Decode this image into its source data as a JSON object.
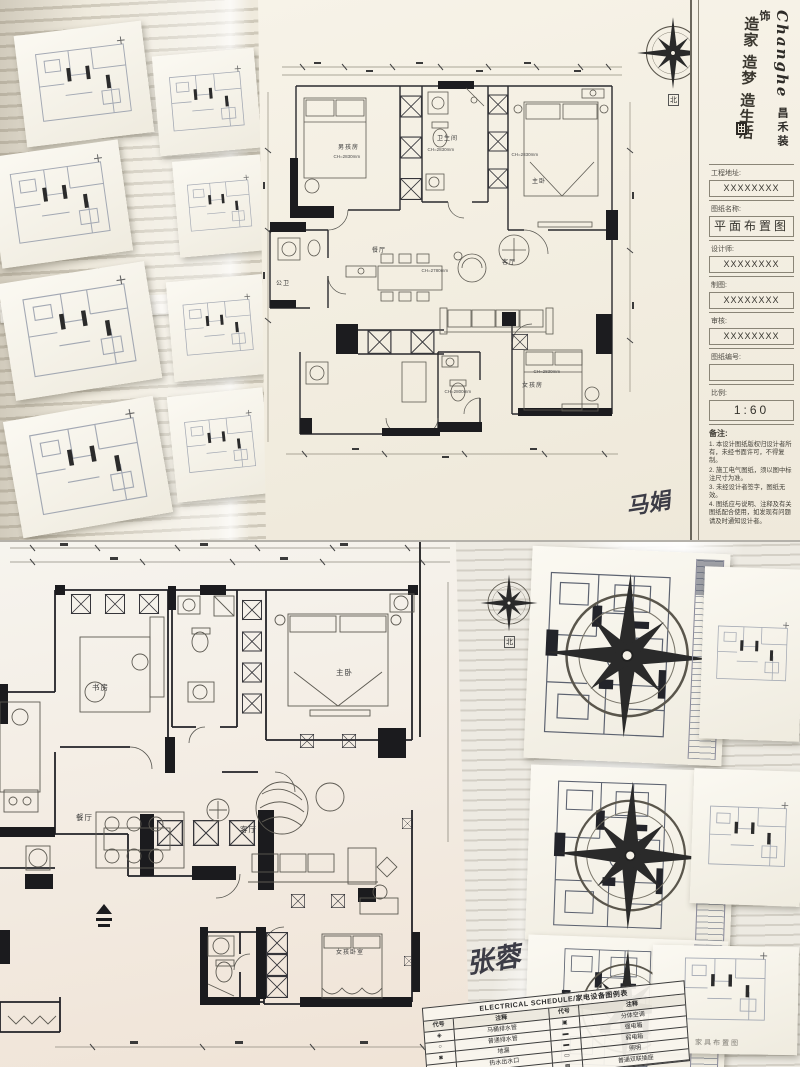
{
  "top": {
    "title_block": {
      "brand_en": "Changhe",
      "brand_cn": "昌禾装饰",
      "slogan": "造家 造梦 造生活",
      "fields": [
        {
          "label": "工程地址:",
          "value": "XXXXXXXX"
        },
        {
          "label": "图纸名称:",
          "value": "平面布置图"
        },
        {
          "label": "设计师:",
          "value": "XXXXXXXX"
        },
        {
          "label": "制图:",
          "value": "XXXXXXXX"
        },
        {
          "label": "审核:",
          "value": "XXXXXXXX"
        },
        {
          "label": "图纸编号:",
          "value": ""
        },
        {
          "label": "比例:",
          "value": "1:60"
        }
      ],
      "notes_title": "备注:",
      "notes": [
        "1. 本设计图纸版权归设计者所有，未经书面许可，不得复制。",
        "2. 施工电气图纸，须以图中标注尺寸为准。",
        "3. 未经设计者签字，图纸无效。",
        "4. 图纸应与说明、注释及有关图纸配合使用，如发现有问题请及时通知设计者。"
      ]
    },
    "compass_label": "北",
    "signature": "马娟",
    "plan": {
      "labels": {
        "boy": "男孩房",
        "bath": "卫生间",
        "master": "主卧",
        "dining": "餐厅",
        "living": "客厅",
        "guest_bath": "公卫",
        "girl": "女孩房"
      },
      "dims": {
        "boy": "CH=2830mm",
        "bath": "CH=2830mm",
        "master": "CH=2830mm",
        "living": "CH=2780mm",
        "girl": "CH=2830mm",
        "girl_bath": "CH=2800mm"
      }
    }
  },
  "bottom": {
    "compass_label": "北",
    "signature": "张蓉",
    "plan": {
      "labels": {
        "study": "书房",
        "master": "主卧",
        "dining": "餐厅",
        "living": "客厅",
        "girl": "女孩卧室"
      }
    },
    "schedule": {
      "title": "ELECTRICAL SCHEDULE/家电设备图例表",
      "headers": [
        "代号",
        "注释",
        "代号",
        "注释"
      ],
      "rows": [
        {
          "s1": "◈",
          "t1": "马桶排水管",
          "s2": "▣",
          "t2": "分体空调"
        },
        {
          "s1": "○",
          "t1": "普通排水管",
          "s2": "▬",
          "t2": "强电箱"
        },
        {
          "s1": "◙",
          "t1": "地漏",
          "s2": "▬",
          "t2": "弱电箱"
        },
        {
          "s1": "●",
          "t1": "热水出水口",
          "s2": "▭",
          "t2": "照明"
        },
        {
          "s1": "○",
          "t1": "净水出水口",
          "s2": "▩",
          "t2": "普通双联插座"
        }
      ]
    },
    "caption": "家具布置图"
  }
}
